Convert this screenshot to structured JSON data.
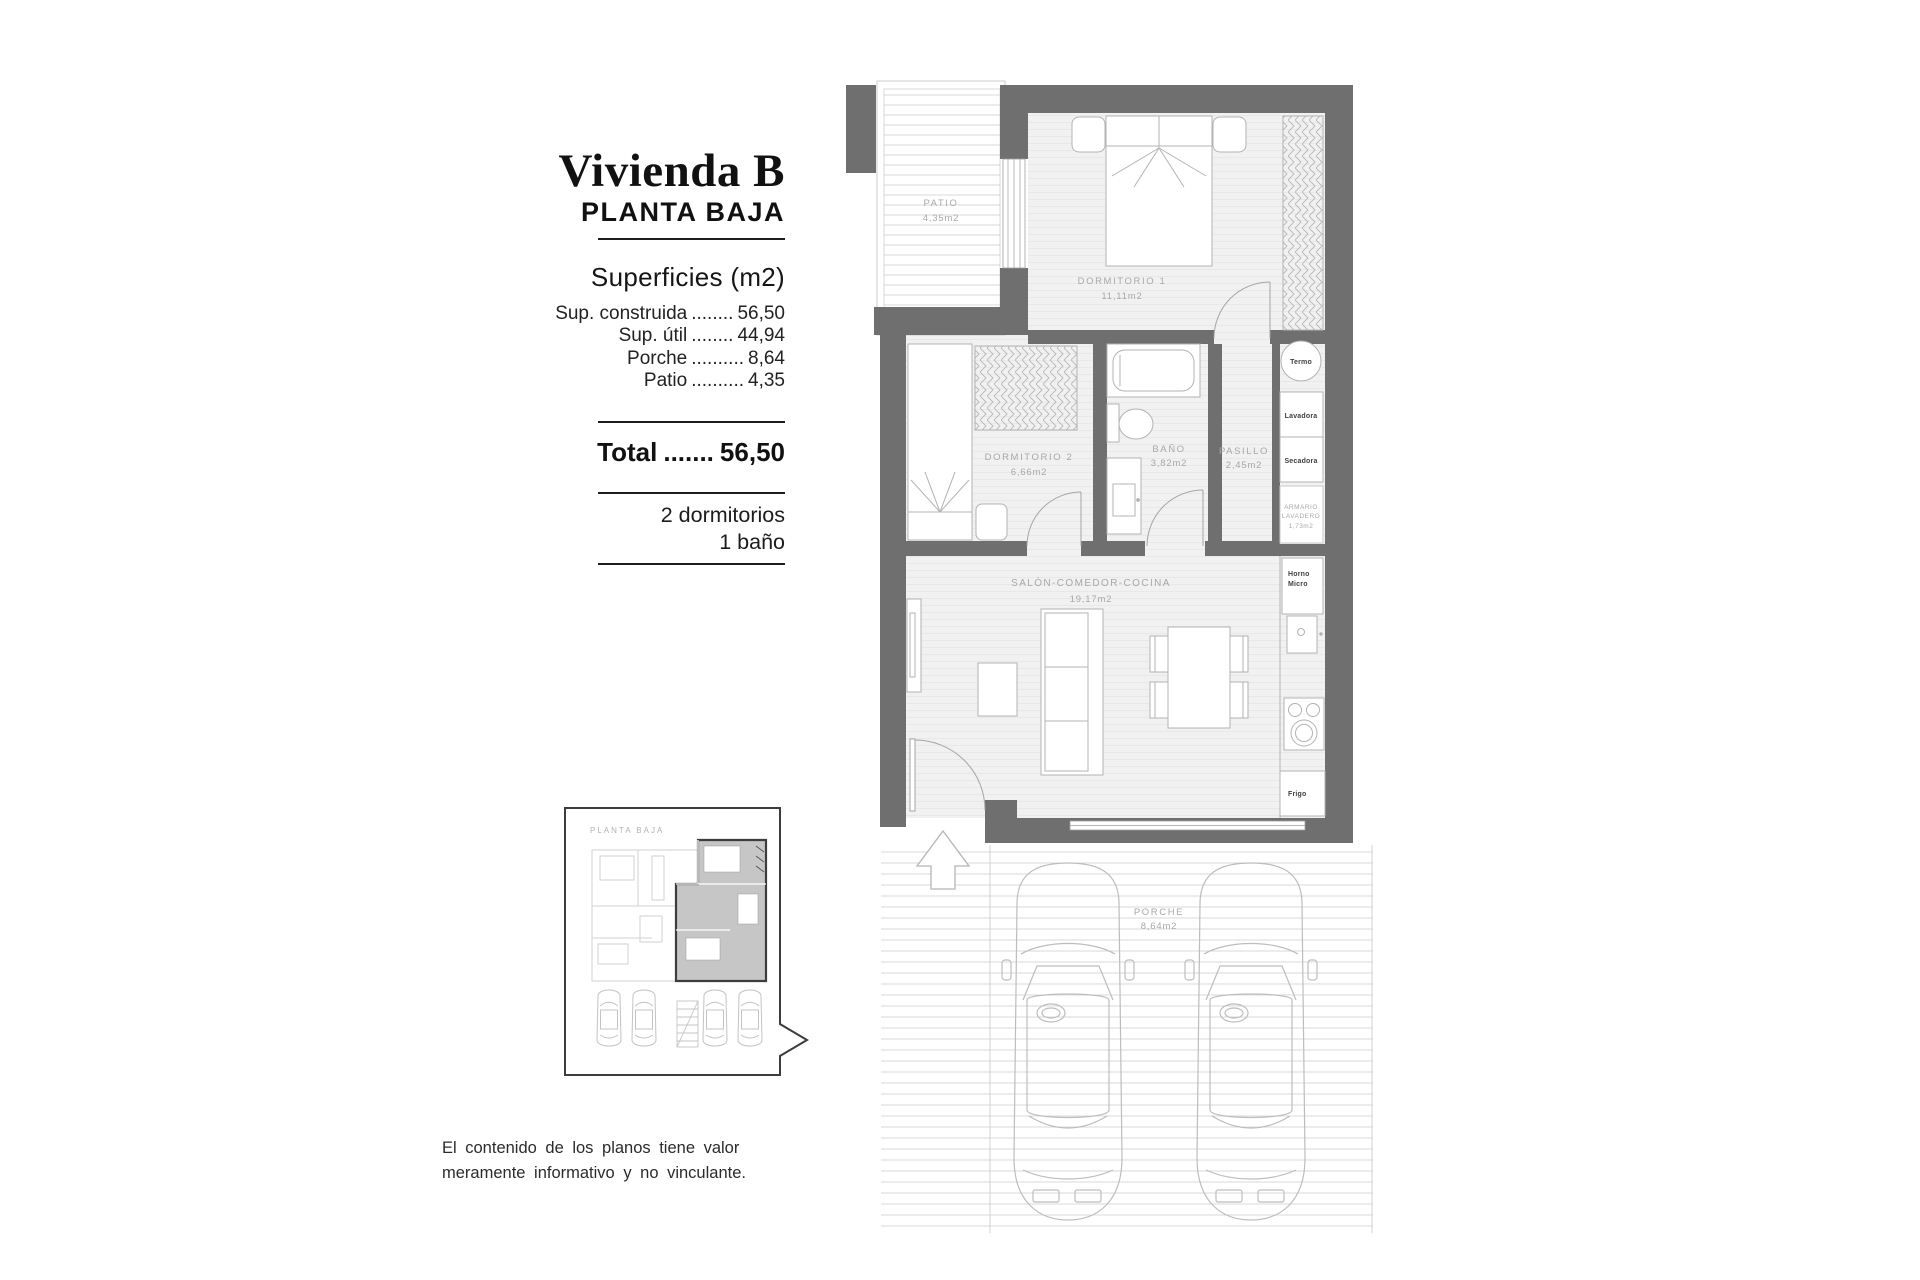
{
  "panel": {
    "title": "Vivienda B",
    "subtitle": "PLANTA BAJA",
    "surfaces_heading": "Superficies (m2)",
    "surfaces": [
      {
        "label": "Sup. construida",
        "dots": "........",
        "value": "56,50"
      },
      {
        "label": "Sup. útil",
        "dots": "........",
        "value": "44,94"
      },
      {
        "label": "Porche",
        "dots": "..........",
        "value": "8,64"
      },
      {
        "label": "Patio",
        "dots": "..........",
        "value": "4,35"
      }
    ],
    "total_label": "Total",
    "total_dots": ".......",
    "total_value": "56,50",
    "features": [
      "2 dormitorios",
      "1 baño"
    ]
  },
  "plan": {
    "rooms": {
      "patio": {
        "name": "PATIO",
        "area": "4,35m2"
      },
      "dormitorio1": {
        "name": "DORMITORIO 1",
        "area": "11,11m2"
      },
      "dormitorio2": {
        "name": "DORMITORIO 2",
        "area": "6,66m2"
      },
      "bano": {
        "name": "BAÑO",
        "area": "3,82m2"
      },
      "pasillo": {
        "name": "PASILLO",
        "area": "2,45m2"
      },
      "salon": {
        "name": "SALÓN-COMEDOR-COCINA",
        "area": "19,17m2"
      },
      "porche": {
        "name": "PORCHE",
        "area": "8,64m2"
      },
      "armario": {
        "name_line1": "ARMARIO",
        "name_line2": "LAVADERO",
        "area": "1,73m2"
      }
    },
    "appliances": {
      "termo": "Termo",
      "lavadora": "Lavadora",
      "secadora": "Secadora",
      "horno_line1": "Horno",
      "horno_line2": "Micro",
      "frigo": "Frigo"
    }
  },
  "inset": {
    "label": "PLANTA BAJA"
  },
  "disclaimer": {
    "line1": "El contenido de los planos tiene valor",
    "line2": "meramente informativo y no vinculante."
  },
  "colors": {
    "wall_gray": "#6f6f6f",
    "floor_gray": "#f1f1f1",
    "label_gray": "#a8a8a8",
    "furniture_line": "#b3b3b3",
    "inset_highlight": "#c6c6c6",
    "text_black": "#111111"
  }
}
